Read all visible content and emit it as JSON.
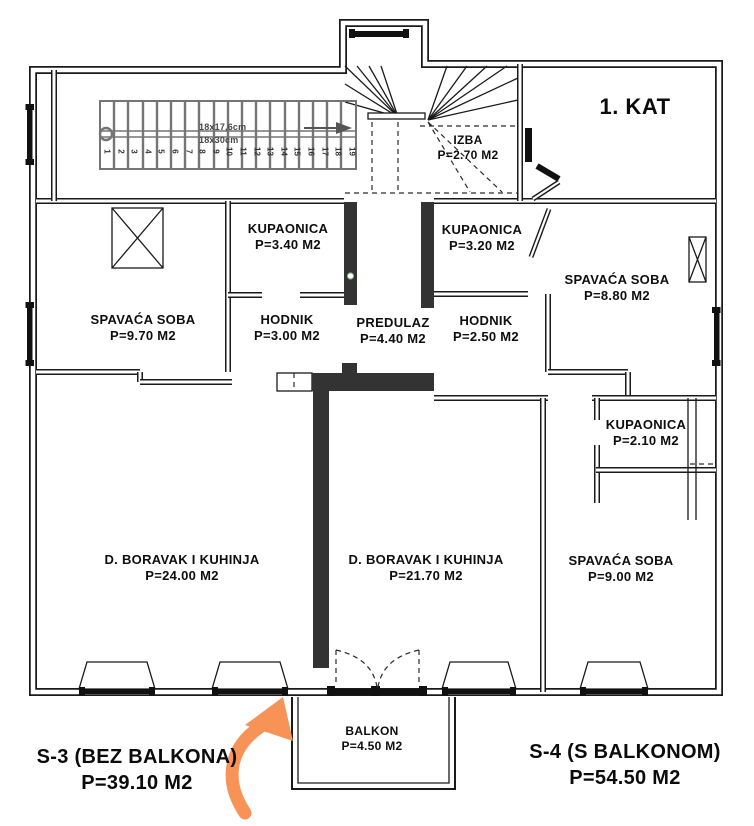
{
  "title": "1. KAT",
  "stair": {
    "dim_line1": "18x17,6cm",
    "dim_line2": "18x30cm",
    "numbers": [
      "1",
      "2",
      "3",
      "4",
      "5",
      "6",
      "7",
      "8",
      "9",
      "10",
      "11",
      "12",
      "13",
      "14",
      "15",
      "16",
      "17",
      "18",
      "19"
    ]
  },
  "rooms": [
    {
      "name": "IZBA",
      "area": "P=2.70 M2"
    },
    {
      "name": "KUPAONICA",
      "area": "P=3.40 M2"
    },
    {
      "name": "KUPAONICA",
      "area": "P=3.20 M2"
    },
    {
      "name": "SPAVAĆA SOBA",
      "area": "P=8.80 M2"
    },
    {
      "name": "SPAVAĆA SOBA",
      "area": "P=9.70 M2"
    },
    {
      "name": "HODNIK",
      "area": "P=3.00 M2"
    },
    {
      "name": "PREDULAZ",
      "area": "P=4.40 M2"
    },
    {
      "name": "HODNIK",
      "area": "P=2.50 M2"
    },
    {
      "name": "KUPAONICA",
      "area": "P=2.10 M2"
    },
    {
      "name": "D. BORAVAK  I KUHINJA",
      "area": "P=24.00 M2"
    },
    {
      "name": "D. BORAVAK  I KUHINJA",
      "area": "P=21.70 M2"
    },
    {
      "name": "SPAVAĆA SOBA",
      "area": "P=9.00 M2"
    },
    {
      "name": "BALKON",
      "area": "P=4.50 M2"
    }
  ],
  "units": [
    {
      "label": "S-3 (BEZ BALKONA)",
      "area": "P=39.10 M2"
    },
    {
      "label": "S-4 (S BALKONOM)",
      "area": "P=54.50 M2"
    }
  ],
  "colors": {
    "arrow": "#F79356",
    "wall_dark": "#333333",
    "line": "#1a1a1a"
  }
}
